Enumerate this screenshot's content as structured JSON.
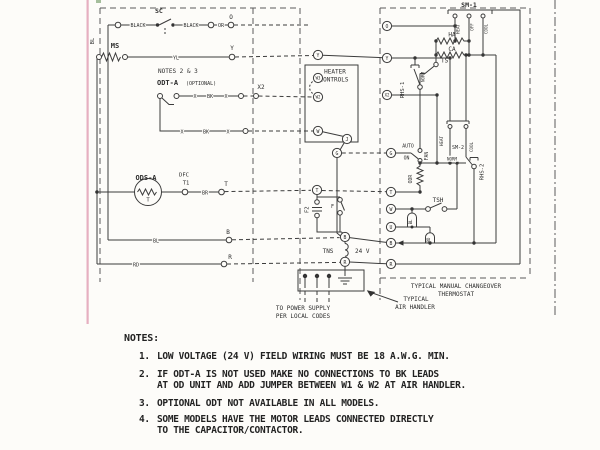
{
  "labels": {
    "sc": "SC",
    "black": "BLACK",
    "or": "OR",
    "o": "O",
    "bl": "BL",
    "ms": "MS",
    "yl": "YL",
    "y": "Y",
    "notes_ref": "NOTES 2 & 3",
    "odt_a": "ODT-A",
    "optional": "(OPTIONAL)",
    "x": "X",
    "bk": "BK",
    "x2": "X2",
    "ods_a": "ODS-A",
    "t": "T",
    "dfc": "DFC",
    "t1": "T1",
    "br": "BR",
    "b": "B",
    "rd": "RD",
    "r": "R",
    "heater": "HEATER",
    "controls": "CONTROLS",
    "w3": "W3",
    "w2": "W2",
    "w": "W",
    "j": "J",
    "g": "G",
    "u": "U",
    "f2": "F2",
    "f": "F",
    "tns": "TNS",
    "v24": "24 V",
    "sm1": "SM-1",
    "sm2": "SM-2",
    "heat": "HEAT",
    "off": "OFF",
    "cool": "COOL",
    "ha": "HA",
    "ca": "CA",
    "ts": "TS",
    "rhs1": "RHS-1",
    "rhs2": "RHS-2",
    "norm": "NORM",
    "auto": "AUTO",
    "on": "ON",
    "fan": "FAN",
    "odr": "ODR",
    "tsh": "TSH",
    "typical": "TYPICAL",
    "air_handler": "AIR HANDLER",
    "power1": "TO POWER SUPPLY",
    "power2": "PER LOCAL CODES",
    "thermostat1": "TYPICAL MANUAL CHANGEOVER",
    "thermostat2": "THERMOSTAT"
  },
  "notes": {
    "title": "NOTES:",
    "items": [
      {
        "num": "1.",
        "line1": "LOW VOLTAGE (24 V) FIELD WIRING MUST BE 18 A.W.G. MIN.",
        "line2": ""
      },
      {
        "num": "2.",
        "line1": "IF ODT-A IS NOT USED MAKE NO CONNECTIONS TO BK LEADS",
        "line2": "AT OD UNIT AND ADD JUMPER BETWEEN W1 & W2 AT AIR HANDLER."
      },
      {
        "num": "3.",
        "line1": "OPTIONAL ODT NOT AVAILABLE IN ALL MODELS.",
        "line2": ""
      },
      {
        "num": "4.",
        "line1": "SOME MODELS HAVE THE MOTOR LEADS CONNECTED DIRECTLY",
        "line2": "TO THE CAPACITOR/CONTACTOR."
      }
    ]
  }
}
